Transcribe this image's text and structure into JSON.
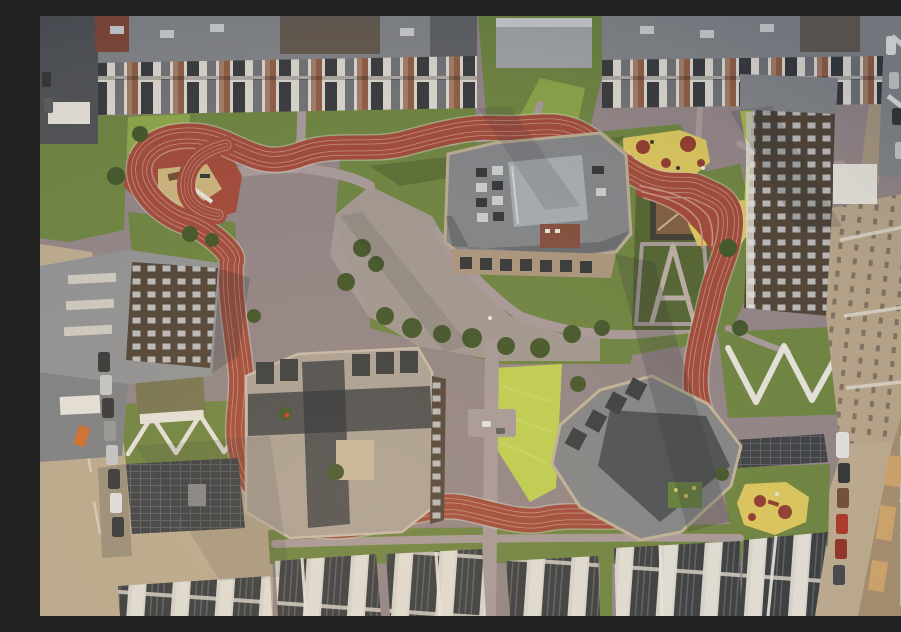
{
  "scene": {
    "type": "aerial-photograph",
    "description": "Golden-hour aerial top-down photograph of a modern residential quarter: a terracotta-red rubber running track loops around a landscaped courtyard with three large grey-roofed apartment buildings, lawns, playgrounds with yellow and red rubber surfacing, zig-zag concrete paths, rooftop solar arrays, and perimeter housing blocks with streets and parked cars. A construction site sits along the right edge.",
    "time_of_day": "golden hour, low sun from the south-west",
    "regions": {
      "running_track": "red running track loop",
      "courtyard": "paved courtyard plaza",
      "central_building_north": "north central apartment building",
      "central_building_southwest": "south-west central apartment building",
      "central_building_southeast": "south-east central apartment building",
      "top_apartment_row": "northern apartment blocks",
      "bottom_apartment_row": "southern apartment blocks with roof terraces",
      "left_building_complex": "western building complex",
      "right_buildings": "eastern apartment buildings",
      "playground_northwest": "north-west playground with red rubber and sand",
      "playground_northeast": "north-east playground with yellow rubber and red circles",
      "playground_southeast": "south-east playground, yellow bean shape",
      "pergola_a": "A-shaped pergola and path area",
      "zigzag_paths_west": "zig-zag path on west lawn",
      "zigzag_paths_east": "zig-zag path on east lawn",
      "solar_array_southwest": "south-west rooftop solar array",
      "solar_array_southeast": "south-east rooftop solar array",
      "left_street": "western street with parked cars",
      "right_street": "eastern street with parked cars",
      "construction_site": "construction site on the east edge",
      "garden_shed": "small shed on north lawn",
      "lawn_hut": "small green-roofed hut on west lawn"
    }
  },
  "colors": {
    "pavement": "#8d8186",
    "pavementLight": "#a29699",
    "pavementBright": "#b5a9a4",
    "street": "#b7a78e",
    "streetShade": "#a2937f",
    "grass": "#68803f",
    "grassDark": "#4d6130",
    "grassBright": "#9cba4f",
    "grassChartreuse": "#bacd4f",
    "bush": "#3c5228",
    "trackRed": "#9c4538",
    "trackLane": "#c08d80",
    "curb": "#cfc5ba",
    "sand": "#c5af7b",
    "yellow": "#d6c35c",
    "circleRed": "#8c382e",
    "roofGray": "#7d8187",
    "roofLight": "#a79e96",
    "roofDark": "#5f636a",
    "roofSilver": "#9fa8b0",
    "roofTan": "#b2a189",
    "facadeWhite": "#d8d5cf",
    "facadeDark": "#32363c",
    "darkBrown": "#4a3f35",
    "brick": "#8a5a44",
    "solar": "#373c43",
    "solarLine": "#545a62",
    "white": "#e2e0da",
    "shadowColor": "#232a33",
    "glass": "#b9c2c9",
    "lumber": "#c9a06a",
    "carDark": "#2f3337",
    "carSilver": "#c0c3c7",
    "carWhite": "#dcdee0",
    "carOrange": "#c96a2e",
    "carRed": "#a63427"
  }
}
